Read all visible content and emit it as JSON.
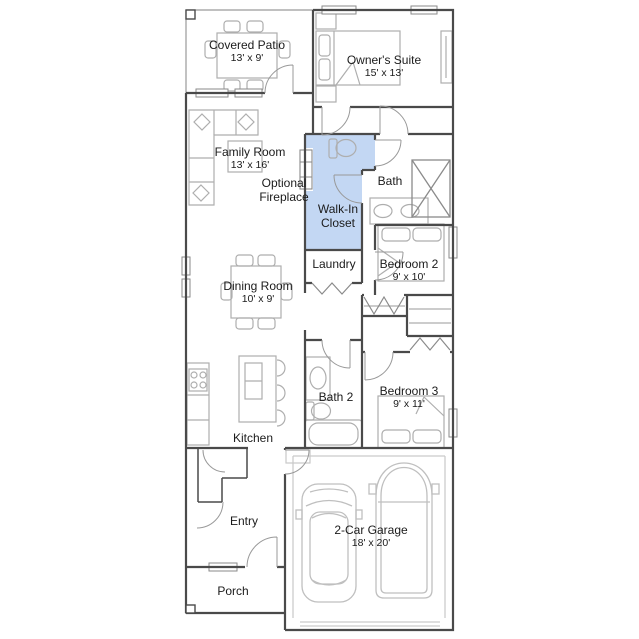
{
  "plan": {
    "colors": {
      "wall": "#4a4a4a",
      "highlight": "#c3d7f3"
    },
    "rooms": {
      "covered_patio": {
        "name": "Covered Patio",
        "dims": "13' x 9'"
      },
      "owners_suite": {
        "name": "Owner's Suite",
        "dims": "15' x 13'"
      },
      "family_room": {
        "name": "Family Room",
        "dims": "13' x 16'"
      },
      "optional_fireplace": {
        "name": "Optional Fireplace"
      },
      "walk_in_closet": {
        "name": "Walk-In Closet"
      },
      "bath": {
        "name": "Bath"
      },
      "laundry": {
        "name": "Laundry"
      },
      "bedroom_2": {
        "name": "Bedroom 2",
        "dims": "9' x 10'"
      },
      "dining_room": {
        "name": "Dining Room",
        "dims": "10' x 9'"
      },
      "bath_2": {
        "name": "Bath 2"
      },
      "bedroom_3": {
        "name": "Bedroom 3",
        "dims": "9' x 11'"
      },
      "kitchen": {
        "name": "Kitchen"
      },
      "entry": {
        "name": "Entry"
      },
      "garage": {
        "name": "2-Car Garage",
        "dims": "18' x 20'"
      },
      "porch": {
        "name": "Porch"
      }
    }
  }
}
